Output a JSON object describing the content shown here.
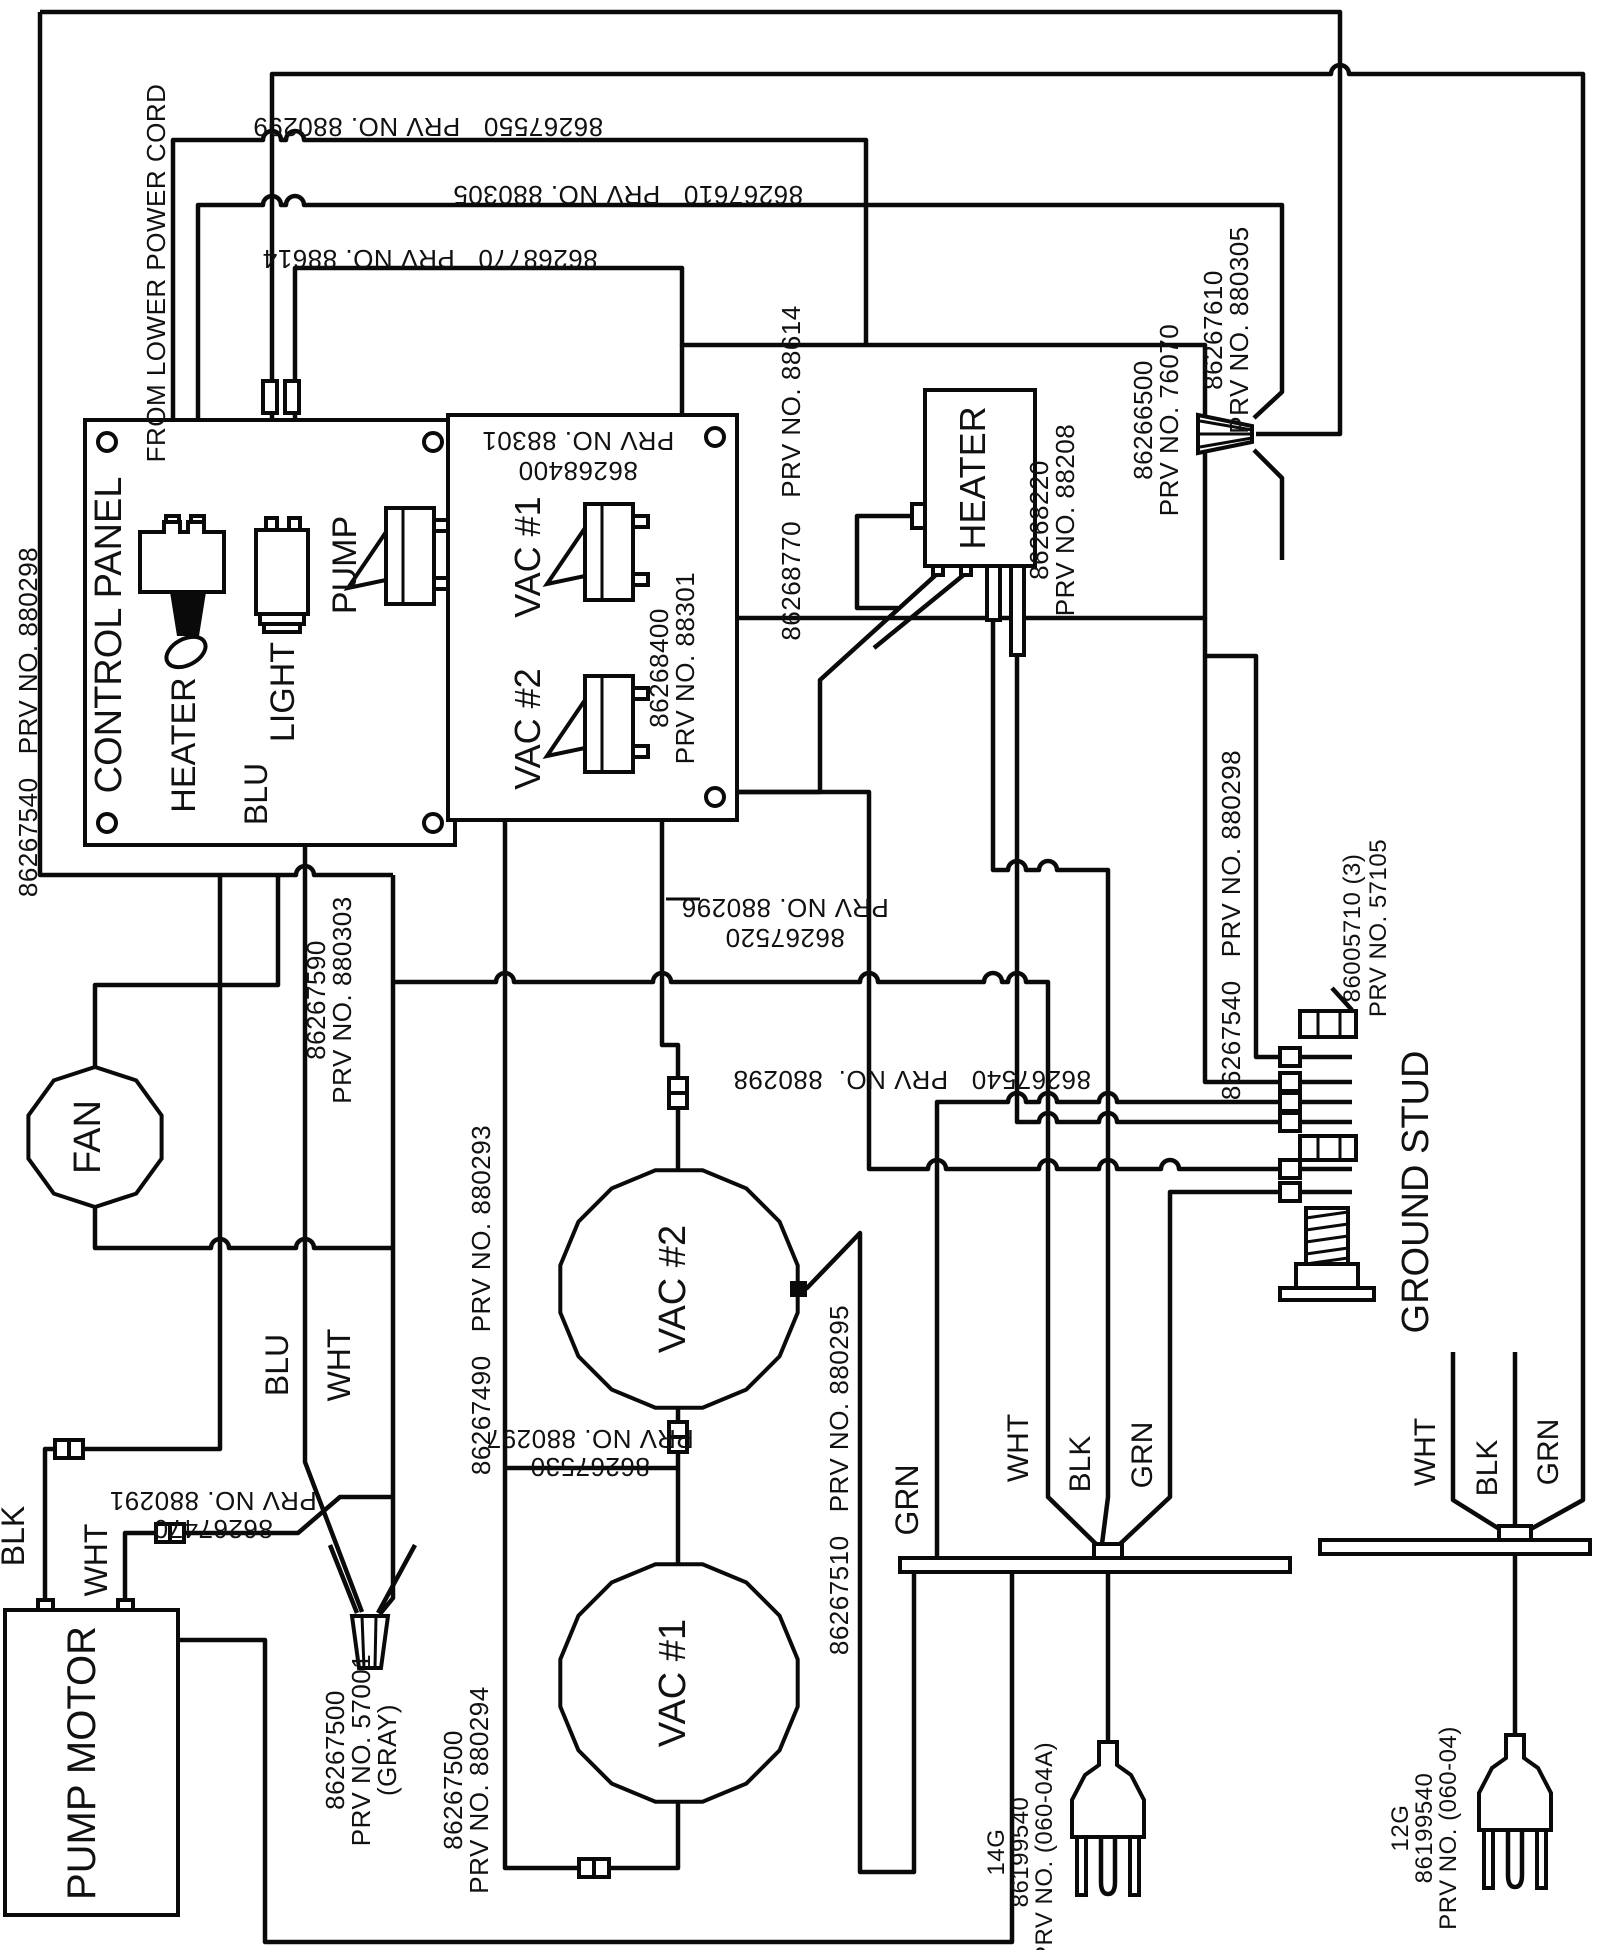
{
  "page": {
    "background": "#ffffff",
    "line_color": "#0a0a0a"
  },
  "notes": {
    "from_power_cord": "FROM LOWER POWER CORD"
  },
  "components": {
    "control_panel": "CONTROL PANEL",
    "heater_switch": "HEATER",
    "light": "LIGHT",
    "pump": "PUMP",
    "vac1_switch": "VAC #1",
    "vac2_switch": "VAC #2",
    "heater": "HEATER",
    "fan": "FAN",
    "vac2": "VAC #2",
    "vac1": "VAC #1",
    "pump_motor": "PUMP MOTOR",
    "ground_stud": "GROUND STUD"
  },
  "wire_colors": {
    "blu": "BLU",
    "wht": "WHT",
    "blk": "BLK",
    "grn": "GRN"
  },
  "part_numbers": {
    "pn_880299": "86267550   PRV NO. 880299",
    "pn_880305": "86267610   PRV NO. 880305",
    "pn_88614": "86268770   PRV NO. 88614",
    "pn_88614_v": "86268770   PRV NO. 88614",
    "pn_88301_a1": "86268400",
    "pn_88301_a2": "PRV NO. 88301",
    "pn_88301_b1": "86268400",
    "pn_88301_b2": "PRV NO. 88301",
    "pn_88208_1": "86268220",
    "pn_88208_2": "PRV NO. 88208",
    "pn_76070_1": "86266500",
    "pn_76070_2": "PRV NO. 76070",
    "pn_880305_b1": "86267610",
    "pn_880305_b2": "PRV NO. 880305",
    "pn_880298_left": "86267540   PRV NO. 880298",
    "pn_880303_1": "86267590",
    "pn_880303_2": "PRV NO. 880303",
    "pn_880296_1": "86267520",
    "pn_880296_2": "PRV NO. 880296",
    "pn_880298_mid": "86267540   PRV NO.  880298",
    "pn_880293": "86267490   PRV NO. 880293",
    "pn_880297_1": "86267530",
    "pn_880297_2": "PRV NO. 880297",
    "pn_880295": "86267510   PRV NO. 880295",
    "pn_880291_1": "86267470",
    "pn_880291_2": "PRV NO. 880291",
    "pn_57001_1": "86267500",
    "pn_57001_2": "PRV NO. 57001",
    "pn_57001_3": "(GRAY)",
    "pn_880294_1": "86267500",
    "pn_880294_2": "PRV NO. 880294",
    "pn_880298_gs": "86267540   PRV NO. 880298",
    "pn_57105_1": "86005710 (3)",
    "pn_57105_2": "PRV NO. 57105",
    "plug14_1": "14G",
    "plug14_2": "86199540",
    "plug14_3": "PRV NO. (060-04A)",
    "plug12_1": "12G",
    "plug12_2": "86199540",
    "plug12_3": "PRV NO. (060-04)"
  }
}
